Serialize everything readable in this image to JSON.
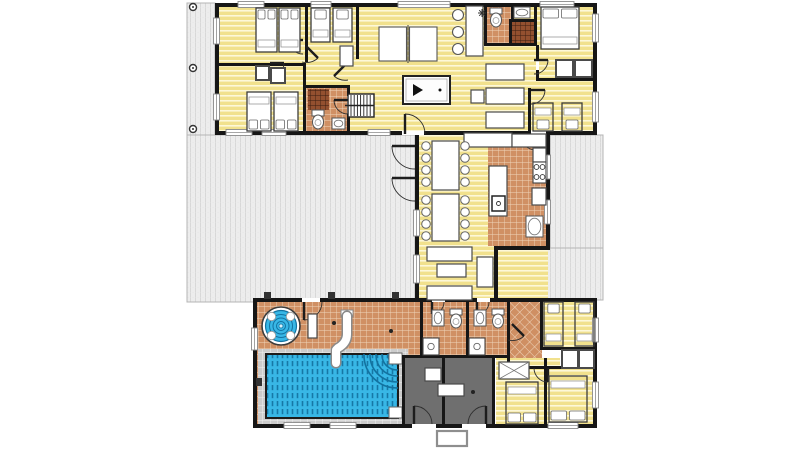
{
  "scene": {
    "w": 800,
    "h": 449,
    "bg": "#ffffff",
    "description": "villa-floor-plan"
  },
  "colors": {
    "wall": "#161616",
    "deck": "#ededed",
    "deck_line": "#d8d8d8",
    "wood": "#f1e18d",
    "wood_line": "#fdf8d8",
    "tile": "#d09064",
    "tile_line": "#efd6bd",
    "darktile": "#93502f",
    "darktile_line": "#3a1d10",
    "dark_room": "#6f6f6f",
    "water": "#38b7e6",
    "water_dark": "#1272a0",
    "surround": "#cccccc",
    "surround_line": "#f0f0f0",
    "furniture_stroke": "#4a4a4a",
    "white": "#ffffff"
  },
  "decks": [
    [
      187,
      3,
      28,
      132
    ],
    [
      187,
      135,
      228,
      167
    ],
    [
      550,
      135,
      53,
      113
    ],
    [
      498,
      248,
      105,
      52
    ]
  ],
  "posts": [
    [
      193,
      7
    ],
    [
      193,
      68
    ],
    [
      193,
      129
    ]
  ],
  "floors": [
    {
      "name": "top-building-floor",
      "x": 217,
      "y": 5,
      "w": 378,
      "h": 128,
      "f": "wood"
    },
    {
      "name": "hall-bathroom-floor",
      "x": 305,
      "y": 87,
      "w": 44,
      "h": 46,
      "f": "tile"
    },
    {
      "name": "hall-bathroom-shower",
      "x": 308,
      "y": 89,
      "w": 21,
      "h": 21,
      "f": "darktile"
    },
    {
      "name": "top-bathroom-floor",
      "x": 486,
      "y": 5,
      "w": 28,
      "h": 40,
      "f": "tile"
    },
    {
      "name": "top-shower-floor",
      "x": 512,
      "y": 21,
      "w": 22,
      "h": 24,
      "f": "darktile"
    },
    {
      "name": "dining-wing-floor",
      "x": 417,
      "y": 133,
      "w": 131,
      "h": 167,
      "f": "wood"
    },
    {
      "name": "kitchen-floor",
      "x": 488,
      "y": 134,
      "w": 58,
      "h": 112,
      "f": "tile"
    },
    {
      "name": "pool-hall-floor",
      "x": 255,
      "y": 300,
      "w": 165,
      "h": 126,
      "f": "tile"
    },
    {
      "name": "pool-surround",
      "x": 258,
      "y": 349,
      "w": 150,
      "h": 75,
      "f": "surround"
    },
    {
      "name": "bathrooms-floor",
      "x": 422,
      "y": 302,
      "w": 88,
      "h": 56,
      "f": "tile"
    },
    {
      "name": "hallway-floor",
      "x": 510,
      "y": 300,
      "w": 32,
      "h": 66,
      "f": "diag"
    },
    {
      "name": "bedroom-ne-floor",
      "x": 542,
      "y": 300,
      "w": 53,
      "h": 50,
      "f": "wood"
    },
    {
      "name": "bedrooms-se-floor",
      "x": 496,
      "y": 358,
      "w": 99,
      "h": 68,
      "f": "wood"
    },
    {
      "name": "closet-floor",
      "x": 560,
      "y": 348,
      "w": 35,
      "h": 20,
      "f": "plain"
    },
    {
      "name": "plant-room-floor",
      "x": 402,
      "y": 358,
      "w": 42,
      "h": 68,
      "f": "dark"
    },
    {
      "name": "plant-room-floor",
      "x": 444,
      "y": 358,
      "w": 50,
      "h": 68,
      "f": "dark"
    }
  ],
  "walls": [
    [
      215,
      3,
      382,
      4
    ],
    [
      215,
      3,
      4,
      132
    ],
    [
      593,
      3,
      4,
      132
    ],
    [
      215,
      131,
      382,
      4
    ],
    [
      305,
      3,
      3,
      59
    ],
    [
      356,
      3,
      3,
      56
    ],
    [
      215,
      63,
      90,
      3
    ],
    [
      303,
      63,
      3,
      70
    ],
    [
      303,
      85,
      47,
      3
    ],
    [
      347,
      85,
      3,
      49
    ],
    [
      484,
      3,
      3,
      43
    ],
    [
      484,
      43,
      53,
      3
    ],
    [
      511,
      5,
      3,
      16
    ],
    [
      509,
      19,
      25,
      3
    ],
    [
      509,
      19,
      3,
      26
    ],
    [
      534,
      3,
      3,
      42
    ],
    [
      536,
      45,
      3,
      15
    ],
    [
      536,
      70,
      3,
      11
    ],
    [
      536,
      78,
      60,
      3
    ],
    [
      528,
      88,
      3,
      45
    ],
    [
      415,
      131,
      4,
      171
    ],
    [
      546,
      131,
      4,
      119
    ],
    [
      494,
      246,
      56,
      4
    ],
    [
      494,
      246,
      4,
      56
    ],
    [
      415,
      298,
      85,
      4
    ],
    [
      253,
      298,
      344,
      4
    ],
    [
      253,
      298,
      4,
      130
    ],
    [
      593,
      298,
      4,
      130
    ],
    [
      253,
      424,
      344,
      4
    ],
    [
      420,
      302,
      3,
      56
    ],
    [
      466,
      302,
      3,
      56
    ],
    [
      507,
      302,
      3,
      68
    ],
    [
      402,
      355,
      108,
      3
    ],
    [
      402,
      355,
      3,
      71
    ],
    [
      442,
      358,
      3,
      68
    ],
    [
      492,
      358,
      3,
      68
    ],
    [
      540,
      302,
      3,
      48
    ],
    [
      542,
      347,
      55,
      3
    ],
    [
      544,
      358,
      3,
      68
    ],
    [
      546,
      366,
      49,
      3
    ],
    [
      507,
      366,
      40,
      3
    ]
  ],
  "wall_gaps": [
    [
      302,
      298,
      18,
      4
    ],
    [
      402,
      131,
      22,
      4
    ],
    [
      531,
      131,
      15,
      4
    ],
    [
      412,
      424,
      24,
      4
    ],
    [
      462,
      424,
      24,
      4
    ],
    [
      432,
      298,
      13,
      4
    ],
    [
      477,
      298,
      13,
      4
    ],
    [
      347,
      96,
      3,
      18
    ],
    [
      536,
      60,
      3,
      10
    ]
  ],
  "windows": [
    [
      238,
      1.5,
      26,
      6
    ],
    [
      311,
      1.5,
      20,
      6
    ],
    [
      398,
      1.5,
      52,
      6
    ],
    [
      540,
      1.5,
      34,
      6
    ],
    [
      213.5,
      18,
      6,
      26
    ],
    [
      213.5,
      94,
      6,
      26
    ],
    [
      592.5,
      14,
      6,
      28
    ],
    [
      592.5,
      92,
      6,
      30
    ],
    [
      226,
      129.5,
      26,
      6
    ],
    [
      262,
      129.5,
      24,
      6
    ],
    [
      368,
      129.5,
      22,
      6
    ],
    [
      413.5,
      210,
      6,
      26
    ],
    [
      413.5,
      255,
      6,
      28
    ],
    [
      544.5,
      155,
      6,
      24
    ],
    [
      544.5,
      200,
      6,
      24
    ],
    [
      251.5,
      328,
      6,
      22
    ],
    [
      284,
      422.5,
      26,
      6
    ],
    [
      330,
      422.5,
      26,
      6
    ],
    [
      548,
      422.5,
      30,
      6
    ],
    [
      592.5,
      318,
      6,
      24
    ],
    [
      592.5,
      382,
      6,
      26
    ]
  ],
  "doors": [
    {
      "leaf": [
        405,
        114,
        405,
        134
      ],
      "arc": "M405,114 A20,20 0 0 1 425,134"
    },
    {
      "leaf": [
        415,
        146,
        392,
        146
      ],
      "arc": "M392,146 A23,23 0 0 0 415,169"
    },
    {
      "leaf": [
        415,
        178,
        392,
        178
      ],
      "arc": "M392,178 A23,23 0 0 0 415,201"
    },
    {
      "leaf": [
        304,
        302,
        304,
        320
      ],
      "arc": "M304,320 A18,18 0 0 0 322,302"
    },
    {
      "leaf": [
        414,
        424,
        414,
        406
      ],
      "arc": "M414,406 A18,18 0 0 1 432,424"
    },
    {
      "leaf": [
        486,
        424,
        486,
        406
      ],
      "arc": "M486,406 A18,18 0 0 0 468,424"
    },
    {
      "leaf": [
        536,
        134,
        536,
        150
      ],
      "arc": "M536,150 A16,16 0 0 1 520,134"
    },
    {
      "leaf": [
        534,
        60,
        548,
        60
      ],
      "arc": "M548,60 A14,14 0 0 1 534,74"
    },
    {
      "leaf": [
        531,
        90,
        545,
        90
      ],
      "arc": "M545,90 A14,14 0 0 1 531,104"
    },
    {
      "leaf": [
        303,
        40,
        289,
        40
      ],
      "arc": "M289,40 A14,14 0 0 0 303,54"
    },
    {
      "leaf": [
        270,
        63,
        284,
        63
      ],
      "arc": "M284,63 A14,14 0 0 1 270,77"
    },
    {
      "leaf": [
        348,
        100,
        334,
        100
      ],
      "arc": "M334,100 A14,14 0 0 0 348,114"
    },
    {
      "leaf": [
        306,
        46,
        318,
        58
      ],
      "arc": "M318,58 A17,17 0 0 1 302,62"
    },
    {
      "leaf": [
        346,
        64,
        334,
        76
      ],
      "arc": "M334,76 A17,17 0 0 0 348,80"
    },
    {
      "leaf": [
        432,
        302,
        432,
        314
      ],
      "arc": "M432,314 A12,12 0 0 0 444,302"
    },
    {
      "leaf": [
        477,
        302,
        477,
        314
      ],
      "arc": "M477,314 A12,12 0 0 0 489,302"
    },
    {
      "leaf": [
        512,
        324,
        524,
        336
      ],
      "arc": "M524,336 A17,17 0 0 1 508,340"
    },
    {
      "leaf": [
        548,
        368,
        548,
        382
      ],
      "arc": "M548,382 A14,14 0 0 1 534,368"
    }
  ],
  "furniture": [
    {
      "t": "bed",
      "name": "bed-double",
      "x": 256,
      "y": 8,
      "w": 21,
      "h": 44,
      "p": "top",
      "n": 2,
      "solid": true
    },
    {
      "t": "bed",
      "name": "bed-double",
      "x": 279,
      "y": 8,
      "w": 21,
      "h": 44,
      "p": "top",
      "n": 2,
      "solid": true
    },
    {
      "t": "bed",
      "name": "bed-single",
      "x": 311,
      "y": 8,
      "w": 19,
      "h": 34,
      "p": "top",
      "n": 1,
      "solid": true
    },
    {
      "t": "bed",
      "name": "bed-single",
      "x": 333,
      "y": 8,
      "w": 19,
      "h": 34,
      "p": "top",
      "n": 1,
      "solid": true
    },
    {
      "t": "bed",
      "name": "bed-single",
      "x": 247,
      "y": 92,
      "w": 24,
      "h": 39,
      "p": "bottom",
      "n": 2,
      "solid": true
    },
    {
      "t": "bed",
      "name": "bed-single",
      "x": 274,
      "y": 92,
      "w": 24,
      "h": 39,
      "p": "bottom",
      "n": 2,
      "solid": true
    },
    {
      "t": "bed",
      "name": "bed-double",
      "x": 541,
      "y": 7,
      "w": 38,
      "h": 42,
      "p": "top",
      "n": 2,
      "solid": true
    },
    {
      "t": "bed",
      "name": "bed-single",
      "x": 533,
      "y": 103,
      "w": 20,
      "h": 28,
      "p": "bottom",
      "n": 1,
      "solid": false
    },
    {
      "t": "bed",
      "name": "bed-single",
      "x": 562,
      "y": 103,
      "w": 20,
      "h": 28,
      "p": "bottom",
      "n": 1,
      "solid": false
    },
    {
      "t": "bed",
      "name": "bed-single",
      "x": 544,
      "y": 302,
      "w": 19,
      "h": 44,
      "p": "top",
      "n": 1,
      "solid": false
    },
    {
      "t": "bed",
      "name": "bed-single",
      "x": 575,
      "y": 302,
      "w": 19,
      "h": 44,
      "p": "top",
      "n": 1,
      "solid": false
    },
    {
      "t": "bed",
      "name": "bed-double",
      "x": 506,
      "y": 382,
      "w": 32,
      "h": 42,
      "p": "bottom",
      "n": 2,
      "solid": false
    },
    {
      "t": "bed",
      "name": "bed-double",
      "x": 549,
      "y": 376,
      "w": 38,
      "h": 46,
      "p": "bottom",
      "n": 2,
      "solid": false
    },
    {
      "t": "box",
      "name": "wardrobe",
      "x": 340,
      "y": 46,
      "w": 13,
      "h": 20
    },
    {
      "t": "box",
      "name": "closet",
      "x": 256,
      "y": 66,
      "w": 13,
      "h": 14,
      "sw": 2
    },
    {
      "t": "box",
      "name": "closet",
      "x": 271,
      "y": 68,
      "w": 14,
      "h": 15,
      "sw": 2
    },
    {
      "t": "pingpong",
      "name": "table-tennis-table",
      "x": 379,
      "y": 27,
      "w": 58,
      "h": 34
    },
    {
      "t": "pooltable",
      "name": "billiard-table",
      "x": 403,
      "y": 76,
      "w": 47,
      "h": 28
    },
    {
      "t": "box",
      "name": "bar-counter",
      "x": 466,
      "y": 6,
      "w": 17,
      "h": 50
    },
    {
      "t": "stool",
      "name": "bar-stool",
      "cx": 458,
      "cy": 15
    },
    {
      "t": "stool",
      "name": "bar-stool",
      "cx": 458,
      "cy": 32
    },
    {
      "t": "stool",
      "name": "bar-stool",
      "cx": 458,
      "cy": 49
    },
    {
      "t": "box",
      "name": "sideboard",
      "x": 464,
      "y": 133,
      "w": 48,
      "h": 14
    },
    {
      "t": "box",
      "name": "kitchen-counter",
      "x": 512,
      "y": 134,
      "w": 34,
      "h": 13
    },
    {
      "t": "box",
      "name": "sofa",
      "x": 486,
      "y": 64,
      "w": 38,
      "h": 16
    },
    {
      "t": "box",
      "name": "sofa",
      "x": 486,
      "y": 88,
      "w": 38,
      "h": 16
    },
    {
      "t": "box",
      "name": "sofa",
      "x": 486,
      "y": 112,
      "w": 38,
      "h": 16
    },
    {
      "t": "box",
      "name": "side-table",
      "x": 471,
      "y": 90,
      "w": 13,
      "h": 13
    },
    {
      "t": "box",
      "name": "dining-table",
      "x": 432,
      "y": 141,
      "w": 27,
      "h": 49
    },
    {
      "t": "box",
      "name": "dining-table",
      "x": 432,
      "y": 194,
      "w": 27,
      "h": 47
    },
    {
      "t": "box",
      "name": "kitchen-island",
      "x": 489,
      "y": 166,
      "w": 18,
      "h": 50
    },
    {
      "t": "islandsink",
      "name": "island-sink",
      "x": 492,
      "y": 196,
      "w": 13,
      "h": 15
    },
    {
      "t": "box",
      "name": "kitchen-counter",
      "x": 533,
      "y": 148,
      "w": 13,
      "h": 14
    },
    {
      "t": "stove",
      "name": "stove",
      "x": 533,
      "y": 162,
      "w": 13,
      "h": 21
    },
    {
      "t": "box",
      "name": "fridge",
      "x": 532,
      "y": 188,
      "w": 14,
      "h": 17
    },
    {
      "t": "sink",
      "name": "kitchen-sink",
      "x": 526,
      "y": 216,
      "w": 17,
      "h": 21
    },
    {
      "t": "box",
      "name": "closet",
      "x": 556,
      "y": 60,
      "w": 17,
      "h": 17,
      "sw": 2
    },
    {
      "t": "box",
      "name": "closet",
      "x": 575,
      "y": 60,
      "w": 17,
      "h": 17,
      "sw": 2
    },
    {
      "t": "box",
      "name": "sofa",
      "x": 427,
      "y": 247,
      "w": 45,
      "h": 14
    },
    {
      "t": "box",
      "name": "sofa",
      "x": 427,
      "y": 286,
      "w": 45,
      "h": 14
    },
    {
      "t": "box",
      "name": "coffee-table",
      "x": 437,
      "y": 264,
      "w": 29,
      "h": 13
    },
    {
      "t": "box",
      "name": "armchair",
      "x": 477,
      "y": 257,
      "w": 16,
      "h": 30
    },
    {
      "t": "box",
      "name": "pool-bench",
      "x": 308,
      "y": 314,
      "w": 9,
      "h": 24
    },
    {
      "t": "box",
      "name": "shelf",
      "x": 425,
      "y": 368,
      "w": 16,
      "h": 13
    },
    {
      "t": "box",
      "name": "shelf",
      "x": 438,
      "y": 384,
      "w": 26,
      "h": 12
    },
    {
      "t": "hatchbox",
      "name": "wardrobe",
      "x": 499,
      "y": 362,
      "w": 30,
      "h": 17
    },
    {
      "t": "box",
      "name": "closet",
      "x": 562,
      "y": 350,
      "w": 16,
      "h": 18,
      "sw": 2
    },
    {
      "t": "box",
      "name": "closet",
      "x": 579,
      "y": 350,
      "w": 15,
      "h": 18,
      "sw": 2
    },
    {
      "t": "stairs",
      "name": "staircase",
      "x": 348,
      "y": 94,
      "w": 26,
      "h": 23
    },
    {
      "t": "toilet",
      "name": "toilet",
      "cx": 318,
      "cy": 121
    },
    {
      "t": "sink",
      "name": "bathroom-sink",
      "x": 332,
      "y": 118,
      "w": 13,
      "h": 11
    },
    {
      "t": "toilet",
      "name": "toilet",
      "cx": 496,
      "cy": 19
    },
    {
      "t": "sink",
      "name": "bathroom-sink",
      "x": 514,
      "y": 7,
      "w": 16,
      "h": 11
    },
    {
      "t": "sink",
      "name": "bathroom-sink",
      "x": 432,
      "y": 310,
      "w": 12,
      "h": 16
    },
    {
      "t": "toilet",
      "name": "toilet",
      "cx": 456,
      "cy": 320
    },
    {
      "t": "sink",
      "name": "bathroom-sink",
      "x": 474,
      "y": 310,
      "w": 12,
      "h": 16
    },
    {
      "t": "toilet",
      "name": "toilet",
      "cx": 498,
      "cy": 320
    },
    {
      "t": "shower",
      "name": "shower-tray",
      "x": 423,
      "y": 338,
      "w": 16,
      "h": 17
    },
    {
      "t": "shower",
      "name": "shower-tray",
      "x": 469,
      "y": 338,
      "w": 16,
      "h": 17
    },
    {
      "t": "mat",
      "name": "entrance-mat",
      "x": 437,
      "y": 431,
      "w": 30,
      "h": 15
    },
    {
      "t": "asterisk",
      "name": "ceiling-fan-symbol",
      "cx": 482,
      "cy": 13
    }
  ],
  "dining_chairs": [
    [
      426,
      146
    ],
    [
      426,
      158
    ],
    [
      426,
      170
    ],
    [
      426,
      182
    ],
    [
      426,
      200
    ],
    [
      426,
      212
    ],
    [
      426,
      224
    ],
    [
      426,
      236
    ],
    [
      465,
      146
    ],
    [
      465,
      158
    ],
    [
      465,
      170
    ],
    [
      465,
      182
    ],
    [
      465,
      200
    ],
    [
      465,
      212
    ],
    [
      465,
      224
    ],
    [
      465,
      236
    ]
  ],
  "pool": {
    "x": 266,
    "y": 354,
    "w": 132,
    "h": 64,
    "steps": [
      [
        389,
        353,
        13,
        11
      ],
      [
        389,
        407,
        13,
        11
      ]
    ],
    "arc_radii": [
      9,
      15,
      21,
      27,
      33
    ]
  },
  "jacuzzi": {
    "cx": 281,
    "cy": 326,
    "r": 19
  },
  "slide": {
    "path": "M347,316 L347,334 Q347,343 338,348 L336,350 L336,363",
    "platform": [
      341,
      310,
      12,
      7
    ]
  },
  "dots": [
    [
      334,
      323
    ],
    [
      391,
      331
    ],
    [
      473,
      392
    ]
  ],
  "marks": [
    [
      264,
      292,
      7,
      7
    ],
    [
      328,
      292,
      7,
      7
    ],
    [
      392,
      292,
      7,
      7
    ],
    [
      256,
      378,
      6,
      8
    ]
  ]
}
